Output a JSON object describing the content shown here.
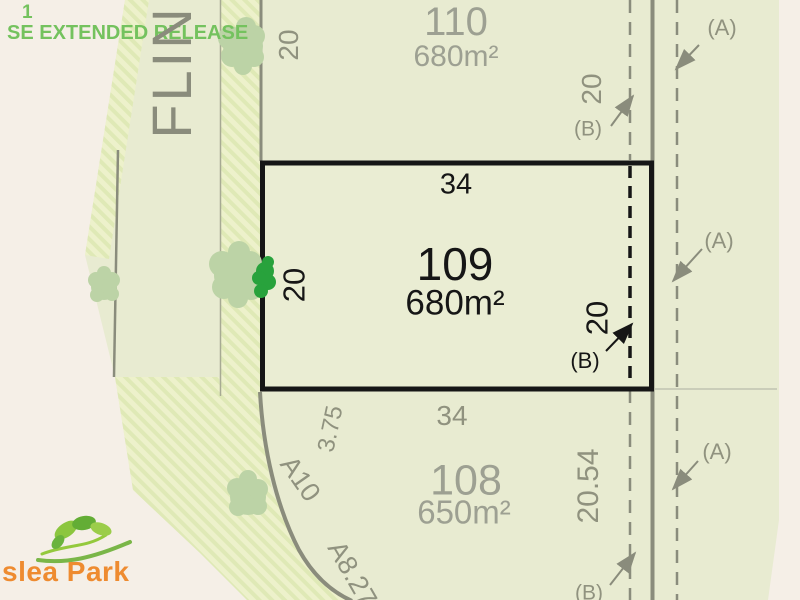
{
  "banner": {
    "line1": "1",
    "line2": "SE EXTENDED RELEASE"
  },
  "street": {
    "name": "FLIN"
  },
  "lot110": {
    "number": "110",
    "area": "680m²",
    "west_dim": "20",
    "east_dim": "20",
    "east_ref": "(B)"
  },
  "lot109": {
    "number": "109",
    "area": "680m²",
    "north_dim": "34",
    "west_dim": "20",
    "east_dim": "20",
    "east_ref": "(B)"
  },
  "lot108": {
    "number": "108",
    "area": "650m²",
    "north_dim": "34",
    "east_dim": "20.54",
    "south_ref": "(B)",
    "boundary_labels": [
      "3.75",
      "A10",
      "A8.27"
    ]
  },
  "easement_refs": {
    "a_top": "(A)",
    "a_mid": "(A)",
    "a_bottom": "(A)"
  },
  "logo": {
    "text": "slea Park"
  },
  "colors": {
    "page_bg": "#f5efe7",
    "plan_bg": "#e8ebd1",
    "lot109_bg": "#eaedd3",
    "line_gray": "#8a8c7c",
    "text_gray": "#90927f",
    "lot_num_gray": "#9da092",
    "lot_black": "#161616",
    "banner_green": "#74c25e",
    "logo_orange": "#ee8b30",
    "tree_green": "#bcd3a6",
    "tree_bright": "#28a23c",
    "hatch_a": "#edf1cb",
    "hatch_b": "#dfe9b6"
  }
}
